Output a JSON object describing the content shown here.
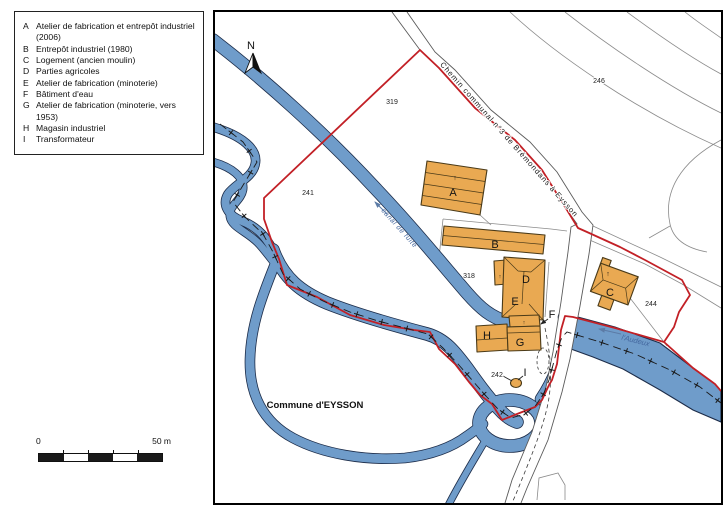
{
  "legend": {
    "items": [
      {
        "key": "A",
        "label": "Atelier de fabrication et entrepôt industriel (2006)"
      },
      {
        "key": "B",
        "label": "Entrepôt industriel (1980)"
      },
      {
        "key": "C",
        "label": "Logement (ancien moulin)"
      },
      {
        "key": "D",
        "label": "Parties agricoles"
      },
      {
        "key": "E",
        "label": "Atelier de fabrication (minoterie)"
      },
      {
        "key": "F",
        "label": "Bâtiment d'eau"
      },
      {
        "key": "G",
        "label": "Atelier de fabrication (minoterie, vers 1953)"
      },
      {
        "key": "H",
        "label": "Magasin industriel"
      },
      {
        "key": "I",
        "label": "Transformateur"
      }
    ]
  },
  "scale_bar": {
    "start_label": "0",
    "end_label": "50 m"
  },
  "map": {
    "north_label": "N",
    "commune_label": "Commune d'EYSSON",
    "road_label": "Chemin communal n°3 de Brémondans à Eysson",
    "canal_label": "canal de fuite",
    "river_label": "l'Audeux",
    "orientation_mark": "↑",
    "parcel_numbers": {
      "p319": "319",
      "p241": "241",
      "p246": "246",
      "p318": "318",
      "p244": "244",
      "p242": "242"
    },
    "building_labels": {
      "A": "A",
      "B": "B",
      "C": "C",
      "D": "D",
      "E": "E",
      "F": "F",
      "G": "G",
      "H": "H",
      "I": "I"
    },
    "colors": {
      "building_fill": "#e9a952",
      "water_fill": "#6f9cca",
      "water_outline": "#1c2c49",
      "boundary_red": "#c22026",
      "water_label": "#44679e"
    }
  }
}
